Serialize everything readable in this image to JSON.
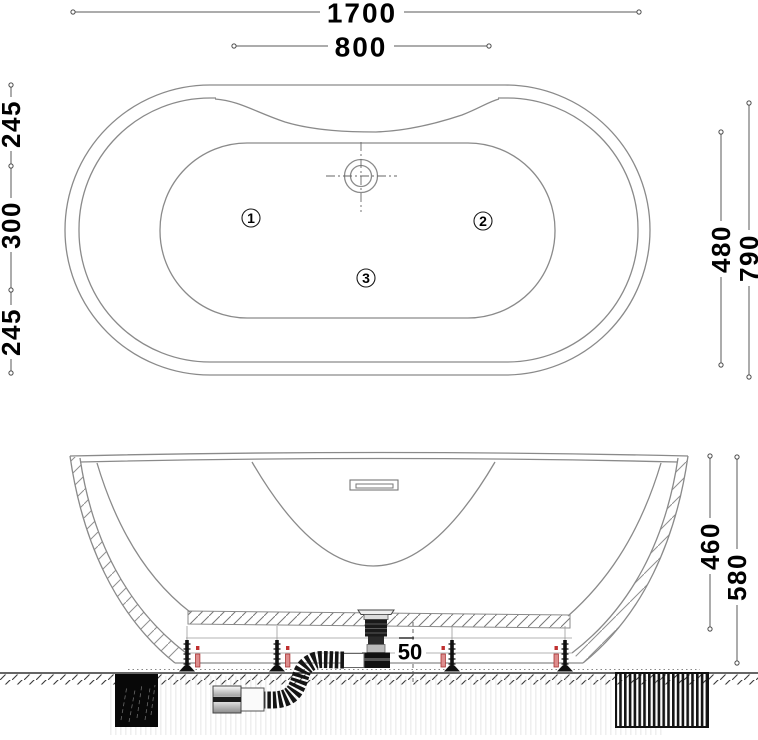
{
  "top_view": {
    "dims": {
      "overall_length": "1700",
      "backrest_width": "800",
      "left_segment_top": "245",
      "left_segment_middle": "300",
      "left_segment_bottom": "245",
      "basin_width": "480",
      "overall_width": "790"
    },
    "jet_labels": [
      "1",
      "2",
      "3"
    ]
  },
  "side_view": {
    "dims": {
      "basin_depth": "460",
      "overall_height": "580",
      "drain_clearance": "50"
    }
  }
}
